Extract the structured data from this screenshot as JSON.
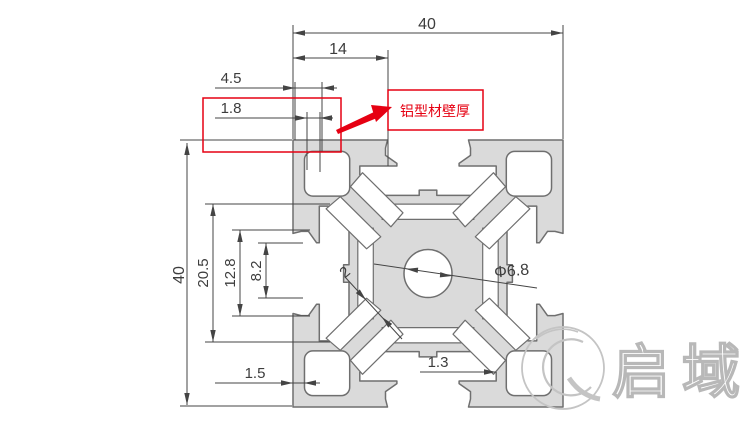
{
  "dimensions": {
    "top_width": "40",
    "top_slot_offset": "14",
    "corner_pocket_offset": "4.5",
    "wall_thickness": "1.8",
    "side_height": "40",
    "slot_cavity_width": "20.5",
    "slot_step_width": "12.8",
    "slot_opening_width": "8.2",
    "bottom_wall": "1.5",
    "slot_floor": "1.3",
    "web_thickness": "2",
    "center_hole_dia": "Φ6.8"
  },
  "annotation": {
    "wall_thickness_label": "铝型材壁厚"
  },
  "watermark": {
    "brand_text": "启域"
  },
  "colors": {
    "profile_fill": "#dadada",
    "profile_stroke": "#6f6f6f",
    "dim_line": "#444444",
    "annotation_red": "#e60012",
    "watermark_gray": "#c4c4c4"
  }
}
